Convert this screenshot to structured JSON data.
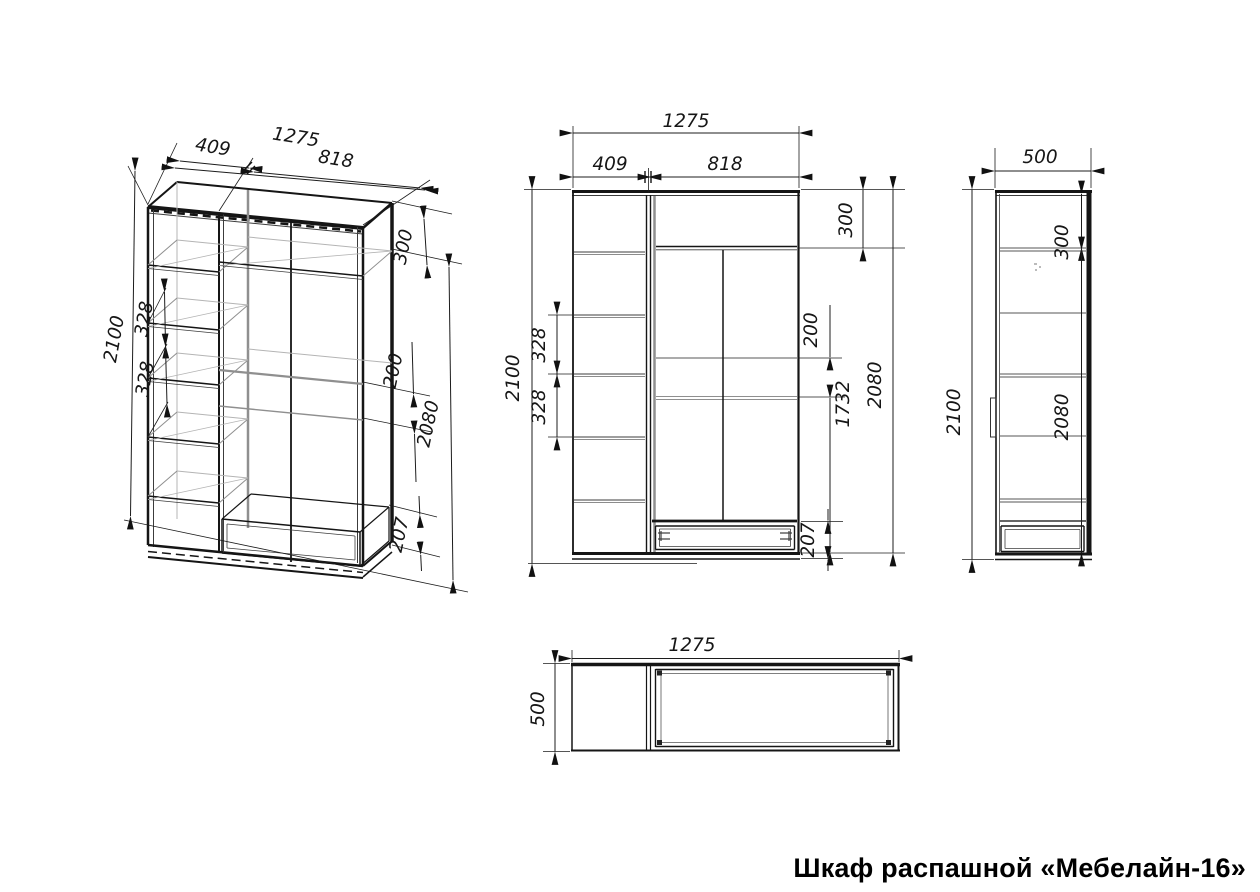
{
  "title": "Шкаф распашной «Мебелайн-16»",
  "drawing": {
    "kind": "furniture technical drawing",
    "views": {
      "isometric": {
        "dims": {
          "overall_width": "1275",
          "left_section_width": "409",
          "right_section_width": "818",
          "overall_height": "2100",
          "shelf_spacing_upper": "328",
          "shelf_spacing_lower": "328",
          "top_compartment_height": "300",
          "rod_drop": "200",
          "interior_height": "2080",
          "drawer_front_height": "207"
        }
      },
      "front": {
        "dims": {
          "overall_width": "1275",
          "left_section_width": "409",
          "right_section_width": "818",
          "overall_height": "2100",
          "shelf_spacing_upper": "328",
          "shelf_spacing_lower": "328",
          "top_compartment_height": "300",
          "rod_drop": "200",
          "door_height": "1732",
          "interior_height": "2080",
          "drawer_front_height": "207"
        }
      },
      "side": {
        "dims": {
          "depth": "500",
          "top_compartment_height": "300",
          "overall_height": "2100",
          "interior_height": "2080"
        }
      },
      "top": {
        "dims": {
          "overall_width": "1275",
          "depth": "500"
        }
      }
    }
  }
}
